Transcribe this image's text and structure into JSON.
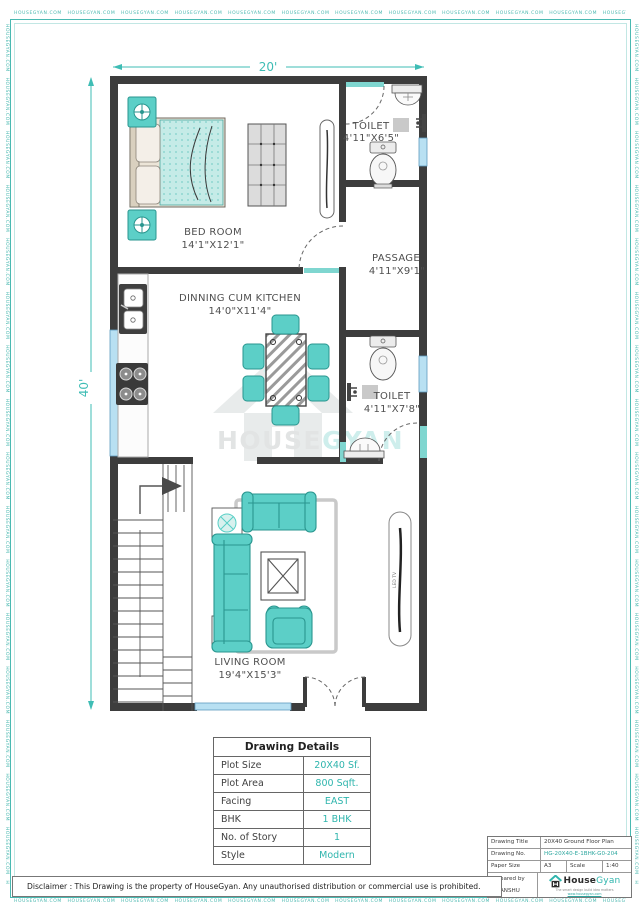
{
  "page": {
    "border_watermark": "HOUSEGYAN.COM",
    "disclaimer": "Disclaimer : This Drawing is the property of HouseGyan. Any unauthorised distribution or commercial use is prohibited."
  },
  "plan": {
    "dim_width": "20'",
    "dim_height": "40'",
    "bedroom_name": "BED ROOM",
    "bedroom_size": "14'1\"X12'1\"",
    "toilet1_name": "TOILET",
    "toilet1_size": "4'11\"X6'5\"",
    "passage_name": "PASSAGE",
    "passage_size": "4'11\"X9'1\"",
    "kitchen_name": "DINNING CUM KITCHEN",
    "kitchen_size": "14'0\"X11'4\"",
    "toilet2_name": "TOILET",
    "toilet2_size": "4'11\"X7'8\"",
    "living_name": "LIVING ROOM",
    "living_size": "19'4\"X15'3\"",
    "tv_label": "LED TV",
    "watermark_house": "HOUSE",
    "watermark_gyan": "GYAN"
  },
  "details": {
    "title": "Drawing Details",
    "rows": [
      {
        "label": "Plot Size",
        "value": "20X40 Sf."
      },
      {
        "label": "Plot Area",
        "value": "800 Sqft."
      },
      {
        "label": "Facing",
        "value": "EAST"
      },
      {
        "label": "BHK",
        "value": "1 BHK"
      },
      {
        "label": "No. of Story",
        "value": "1"
      },
      {
        "label": "Style",
        "value": "Modern"
      }
    ]
  },
  "title_block": {
    "drawing_title_label": "Drawing Title",
    "drawing_title": "20X40 Ground Floor Plan",
    "drawing_no_label": "Drawing No.",
    "drawing_no": "HG-20X40-E-1BHK-G0-204",
    "paper_size_label": "Paper Size",
    "paper_size": "A3",
    "scale_label": "Scale",
    "scale": "1:40",
    "prepared_by_label": "Prepared by",
    "prepared_by": "DIPANSHU",
    "brand_house": "House",
    "brand_gyan": "Gyan",
    "brand_tagline": "The smart design build idea matters",
    "brand_site": "www.housegyan.com"
  }
}
